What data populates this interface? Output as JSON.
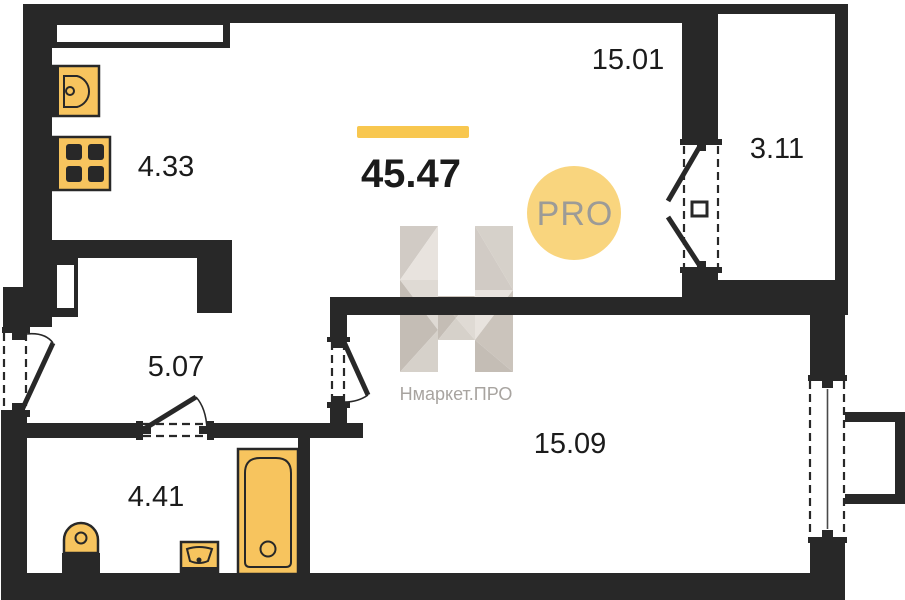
{
  "floorplan": {
    "total": {
      "area": "45.47"
    },
    "rooms": {
      "living": {
        "area": "15.01"
      },
      "balcony": {
        "area": "3.11"
      },
      "kitchen": {
        "area": "4.33"
      },
      "hallway": {
        "area": "5.07"
      },
      "bedroom": {
        "area": "15.09"
      },
      "bathroom": {
        "area": "4.41"
      }
    },
    "watermark": {
      "pro_badge": "PRO",
      "brand": "Нмаркет.ПРО"
    },
    "fixtures": [
      "kitchen-sink",
      "stove",
      "toilet",
      "bathroom-sink",
      "bathtub"
    ],
    "colors": {
      "wall": "#282828",
      "fixture_fill": "#f7c45e",
      "accent_bar": "#f8c74f",
      "pro_circle": "#f9d57e",
      "pro_text": "#9c9b97",
      "watermark_gray": "#a8a4a0",
      "label_text": "#1b1b1b"
    }
  }
}
